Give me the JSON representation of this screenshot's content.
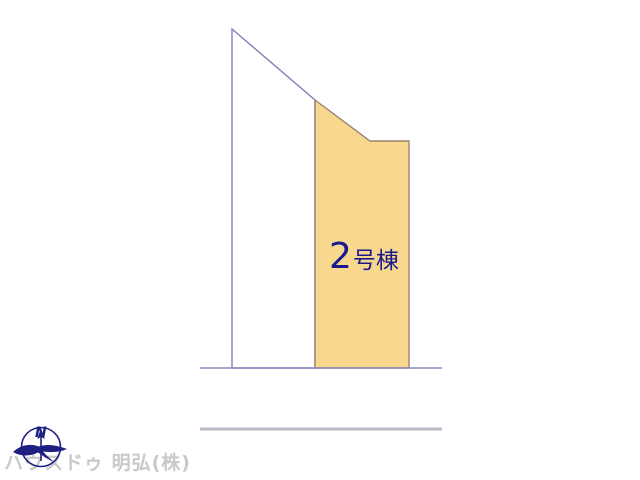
{
  "diagram": {
    "type": "real-estate-site-plan",
    "lot_label": {
      "full_text": "2号棟",
      "number": "2",
      "suffix": "号棟"
    },
    "compass": {
      "label": "N"
    },
    "watermark": "ハウスドゥ 明弘(株)",
    "colors": {
      "lot2_fill": "#f8d88e",
      "lot2_stroke": "#9b8372",
      "adjacent_lot_stroke": "#8183b8",
      "road_line_near": "#898bc0",
      "road_line_far": "#b9bbc6",
      "lot_label_color": "#1a1a8e",
      "compass_color": "#1e2080",
      "watermark_color": "#c9c9c9",
      "background": "#ffffff"
    },
    "shapes": {
      "adjacent_lot_points": "232,29 315,100 315,368 232,368",
      "lot2_points": "315,100 370,141 409,141 409,368 315,368",
      "road_line_near": "200,368 442,368",
      "road_line_far": "200,429 442,429"
    }
  }
}
